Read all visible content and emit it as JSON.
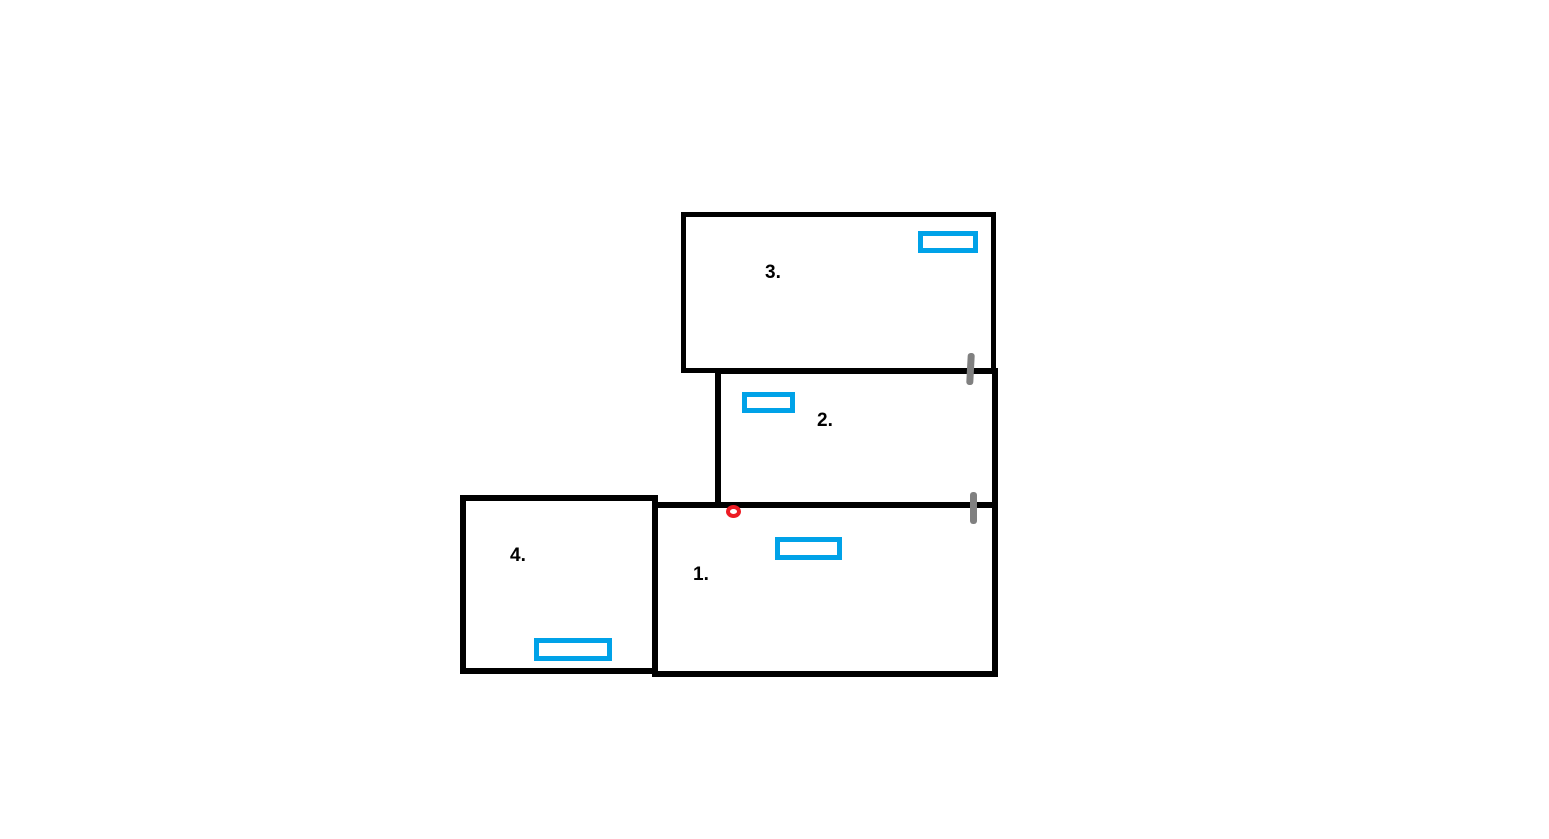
{
  "canvas": {
    "background": "#ffffff",
    "width": 1549,
    "height": 839
  },
  "colors": {
    "wall": "#000000",
    "window": "#00a2e8",
    "door_marker": "#808080",
    "entry_marker": "#ed1c24"
  },
  "diagram": {
    "type": "floor-plan-sketch",
    "rooms": [
      {
        "id": "room-1",
        "label": "1.",
        "features": [
          "window-rectangle",
          "entry-marker-on-top-wall",
          "door-marker-right-wall"
        ]
      },
      {
        "id": "room-2",
        "label": "2.",
        "features": [
          "window-rectangle",
          "door-marker-top-right-wall"
        ]
      },
      {
        "id": "room-3",
        "label": "3.",
        "features": [
          "window-rectangle",
          "door-marker-bottom-right-wall"
        ]
      },
      {
        "id": "room-4",
        "label": "4.",
        "features": [
          "window-rectangle"
        ]
      }
    ],
    "marker_counts": {
      "windows": 4,
      "door_markers": 2,
      "entry_markers": 1
    }
  }
}
